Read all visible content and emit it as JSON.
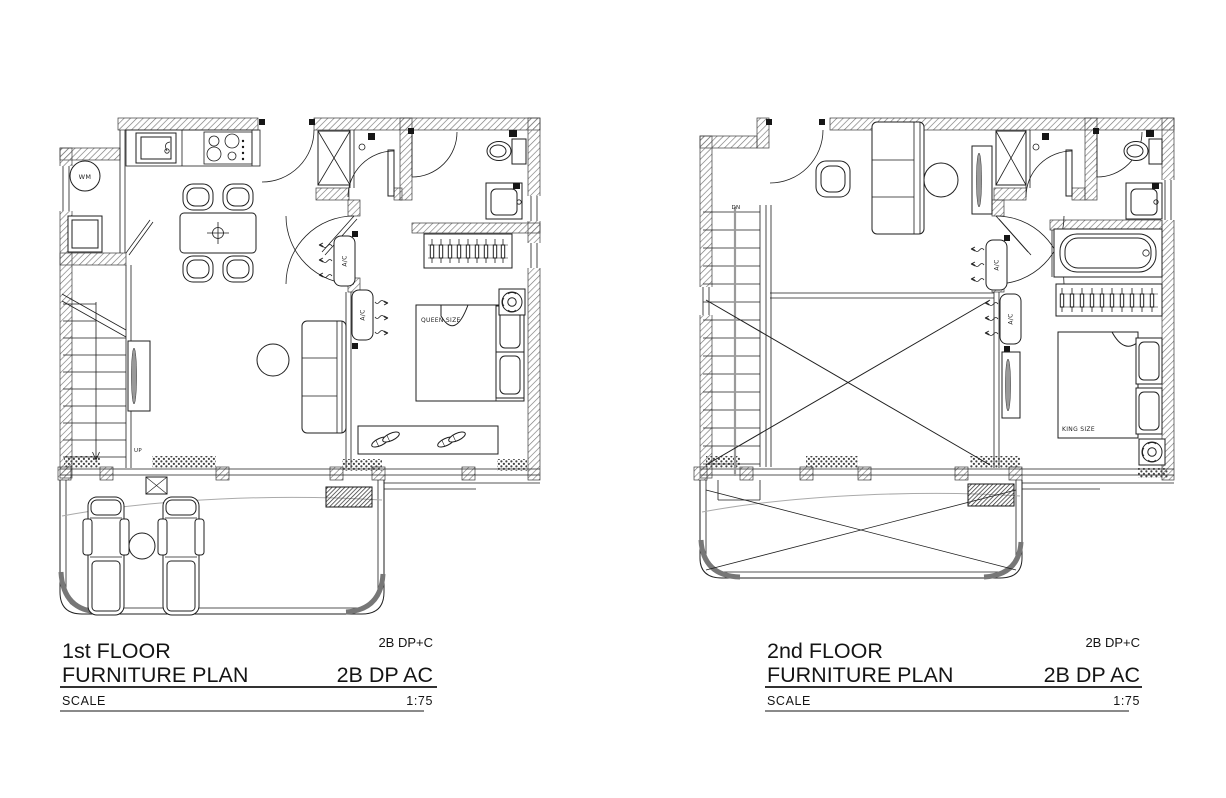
{
  "colors": {
    "background": "#ffffff",
    "ink": "#1f1f1f",
    "wall_hatch": "#6b6b6b",
    "handrail_gray": "#9a9a9a"
  },
  "floor1": {
    "title_line1": "1st FLOOR",
    "title_line2": "FURNITURE PLAN",
    "unit_code_small": "2B DP+C",
    "unit_code_large": "2B DP AC",
    "scale_label": "SCALE",
    "scale_value": "1:75",
    "labels": {
      "washing_machine": "WM",
      "ac_upper": "A/C",
      "ac_lower": "A/C",
      "bed": "QUEEN SIZE",
      "stairs": "UP"
    }
  },
  "floor2": {
    "title_line1": "2nd FLOOR",
    "title_line2": "FURNITURE PLAN",
    "unit_code_small": "2B DP+C",
    "unit_code_large": "2B DP AC",
    "scale_label": "SCALE",
    "scale_value": "1:75",
    "labels": {
      "ac_upper": "A/C",
      "ac_lower": "A/C",
      "bed": "KING SIZE",
      "stairs": "DN"
    }
  }
}
